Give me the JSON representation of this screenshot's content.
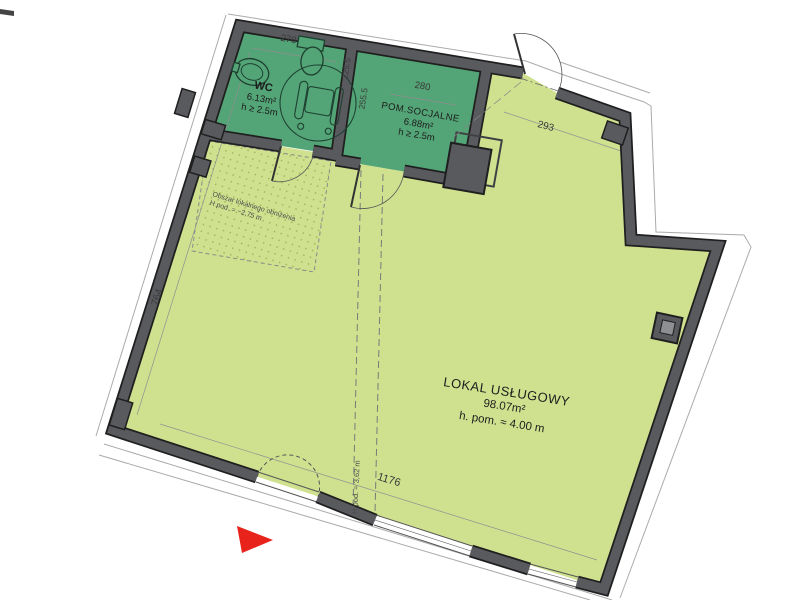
{
  "plan": {
    "rooms": {
      "wc": {
        "name": "WC",
        "area": "6.13m²",
        "height": "h ≥ 2.5m"
      },
      "social": {
        "name": "POM.SOCJALNE",
        "area": "6.88m²",
        "height": "h ≥ 2.5m"
      },
      "main": {
        "name": "LOKAL USŁUGOWY",
        "area": "98.07m²",
        "height": "h. pom. ≈ 4.00 m"
      }
    },
    "dimensions": {
      "wc_top": "278",
      "wc_partition": "225.5",
      "social_partition": "255.5",
      "social_top": "280",
      "top_right_wall": "293",
      "left_wall": "764",
      "bottom_wall": "1176"
    },
    "annotations": {
      "lowered_ceiling_line1": "Obszar lokalnego obniżenia",
      "lowered_ceiling_line2": "H pod. = ~2,75 m",
      "ceiling_height_boundary": "H pod. = 3,62 m"
    },
    "colors": {
      "main_room": "#cfe18f",
      "service_room": "#53a476",
      "wall": "#595a5e",
      "entrance_marker": "#e8231c"
    }
  }
}
